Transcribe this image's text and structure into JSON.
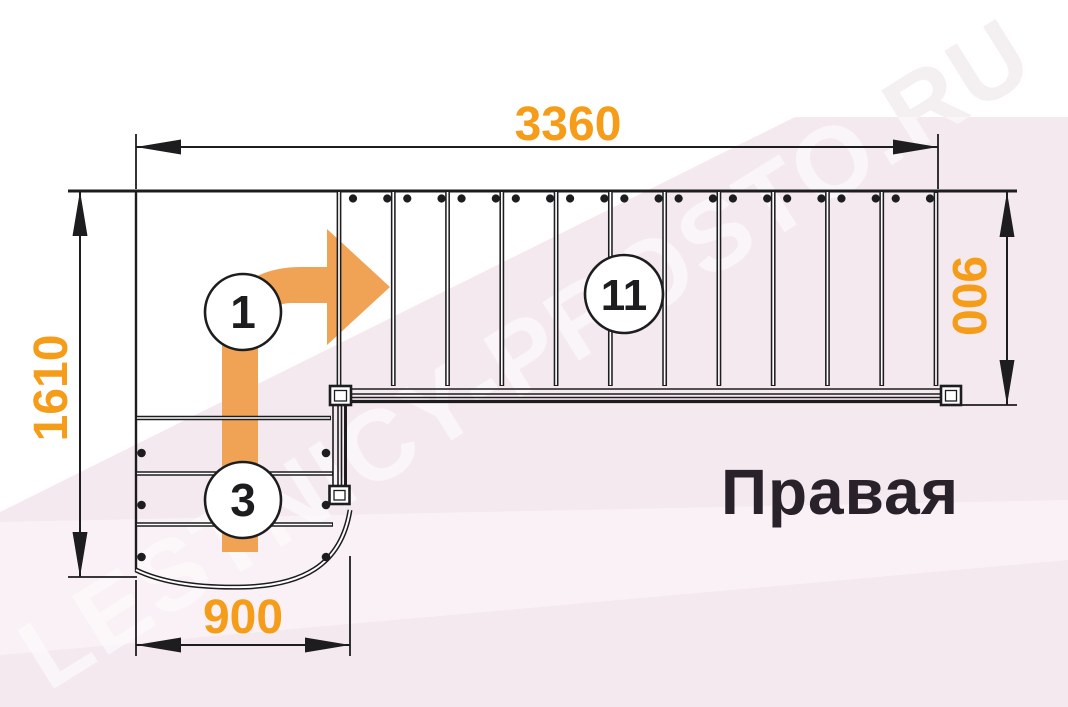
{
  "diagram": {
    "type": "staircase-plan-top-view",
    "side_label": "Правая",
    "watermark_text": "LESTNICY-PROSTO.RU",
    "dimensions": {
      "total_length": "3360",
      "total_width": "1610",
      "upper_flight_width": "900",
      "lower_flight_width": "900"
    },
    "step_labels": {
      "step1": "1",
      "step3": "3",
      "step11": "11"
    },
    "stair": {
      "upper_treads": 11,
      "lower_treads": 3,
      "turn": "right-90"
    },
    "colors": {
      "dimension_text": "#f59c18",
      "direction_arrow": "#f0a355",
      "drawing_lines": "#1d1d1f",
      "background_pink": "#f5e9f0",
      "background_pink_light": "#faf1f6",
      "watermark_gray": "#e7dee4"
    }
  }
}
